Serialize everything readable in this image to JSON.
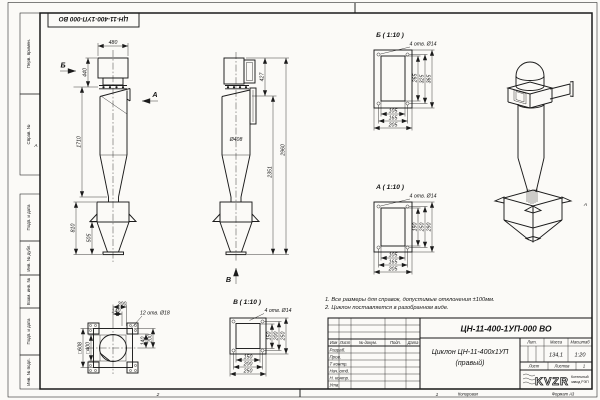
{
  "frame": {
    "corner_stamp": "ЦН-11-400-1УП-000 ВО",
    "zone_left": "А",
    "zone_right": "А",
    "bottom_zone_2": "2",
    "bottom_zone_1": "1",
    "copied": "Копировал",
    "format": "Формат А3"
  },
  "margin": {
    "labels": [
      "Перв. примен.",
      "Справ. №",
      "Подп. и дата",
      "Инв. № дубл.",
      "Взам. инв. №",
      "Подп. и дата",
      "Инв. № подл."
    ]
  },
  "front_view": {
    "dim_width_top": "480",
    "dim_h_top": "440",
    "dim_h_body": "1710",
    "dim_h_hopper": "810",
    "dim_h_pyramid": "505",
    "arrow_b": "Б",
    "arrow_a": "А"
  },
  "side_view": {
    "dim_h_outlet": "427",
    "dim_h_lower": "2351",
    "dim_h_total": "2960",
    "dim_dia": "Ø408",
    "arrow_v": "В"
  },
  "details": {
    "b": {
      "title": "Б ( 1:10 )",
      "holes": "4 отв. Ø14",
      "dim_v": [
        "265",
        "325",
        "365"
      ],
      "dim_h": [
        "105",
        "165",
        "205"
      ]
    },
    "a": {
      "title": "А ( 1:10 )",
      "holes": "4 отв. Ø14",
      "dim_v": [
        "190",
        "250",
        "290"
      ],
      "dim_h": [
        "105",
        "165",
        "205"
      ]
    },
    "v": {
      "title": "В ( 1:10 )",
      "holes": "4 отв. Ø14",
      "dim_v": [
        "150",
        "200",
        "250"
      ],
      "dim_h": [
        "150",
        "200",
        "250"
      ]
    }
  },
  "plan_view": {
    "dim_top_1": "200",
    "dim_top_2": "140",
    "holes": "12 отв. Ø18",
    "dim_right_1": "140",
    "dim_right_2": "200",
    "dim_left_outer": "□608",
    "dim_left_inner": "□400"
  },
  "notes": {
    "line1": "1. Все размеры для справок, допустимые отклонения ±100мм.",
    "line2": "2. Циклон поставляется в разобранном виде."
  },
  "title_block": {
    "doc_number": "ЦН-11-400-1УП-000 ВО",
    "name_line1": "Циклон ЦН-11-400х1УП",
    "name_line2": "(правый)",
    "col_izm": "Изм",
    "col_list": "Лист",
    "col_dokum": "№ докум.",
    "col_podp": "Подп.",
    "col_data": "Дата",
    "rows": [
      "Разраб.",
      "Пров.",
      "Т контр.",
      "Нач. отд.",
      "Н. контр.",
      "Утв."
    ],
    "hdr_lit": "Лит.",
    "hdr_massa": "Масса",
    "hdr_masshtab": "Масштаб",
    "massa_value": "134,1",
    "masshtab_value": "1:20",
    "hdr_list": "Лист",
    "hdr_listov": "Листов",
    "listov_value": "1",
    "logo": "KVZR",
    "company_line1": "Котельный",
    "company_line2": "завод РЭП"
  }
}
